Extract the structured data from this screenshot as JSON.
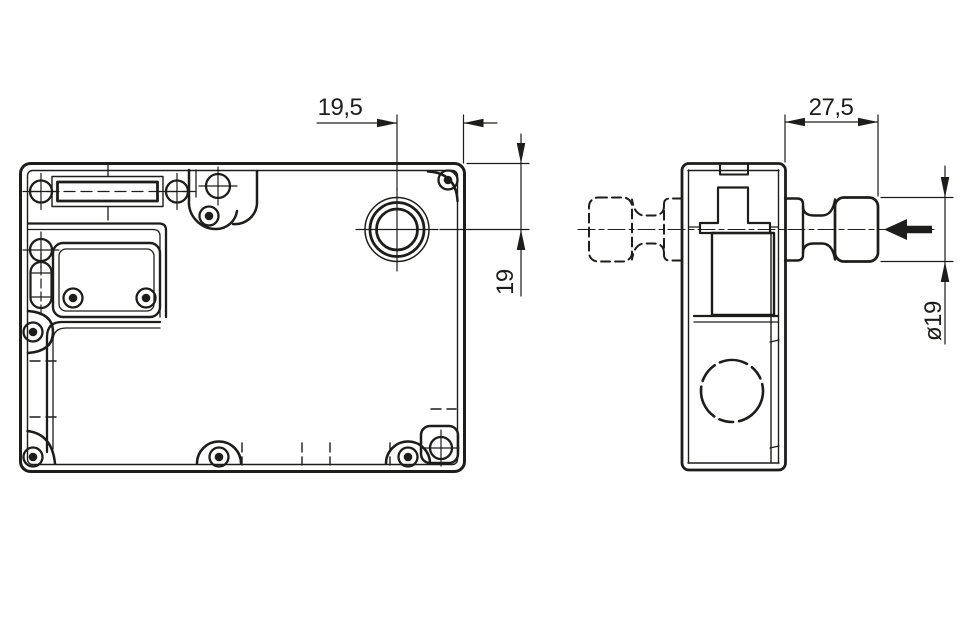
{
  "drawing": {
    "background_color": "#ffffff",
    "line_color": "#1d1d1b",
    "dimensions": {
      "plunger_axis_to_edge": "19,5",
      "plunger_axis_to_top": "19",
      "actuator_projection": "27,5",
      "actuator_diameter": "ø19"
    }
  }
}
